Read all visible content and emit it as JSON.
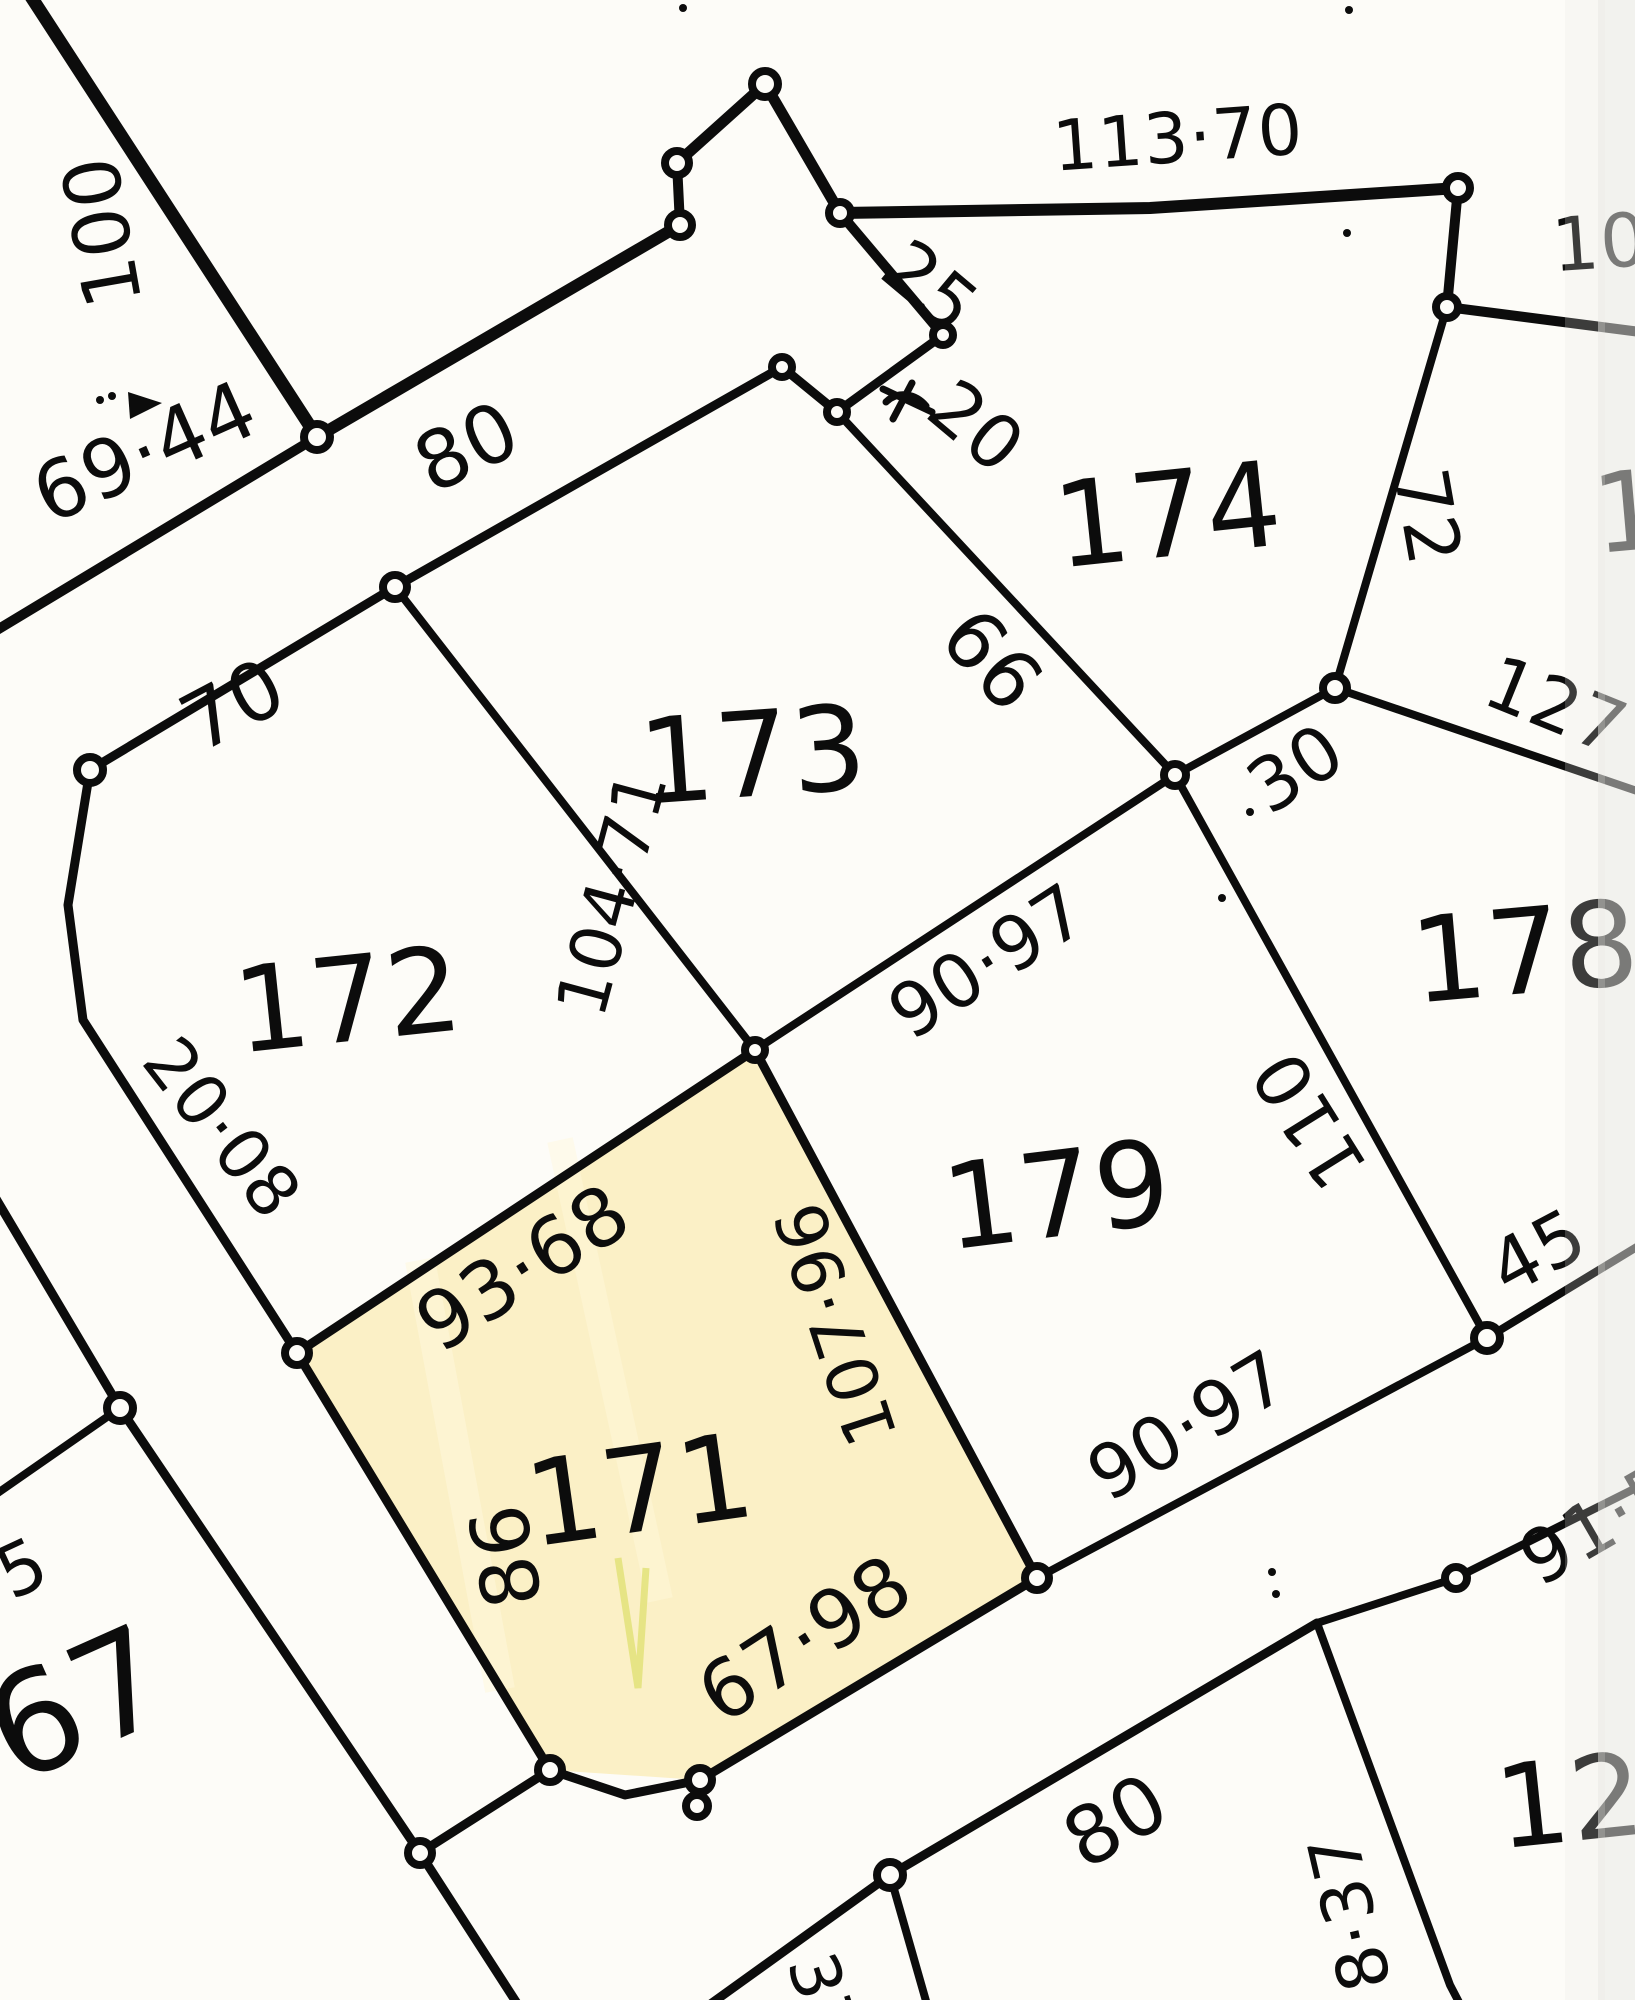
{
  "canvas": {
    "width": 1635,
    "height": 2000,
    "background": "#fdfcf8",
    "ink": "#0c0c0c",
    "edge_shade": "#e7e7e4"
  },
  "highlight": {
    "lot": "171",
    "fill": "#fbf0c6",
    "streak": "#fff8dc",
    "pen_mark": "#e2e279",
    "polygon": [
      [
        297,
        1353
      ],
      [
        755,
        1050
      ],
      [
        1037,
        1578
      ],
      [
        700,
        1780
      ],
      [
        550,
        1770
      ]
    ]
  },
  "labels": [
    {
      "name": "lot-number-171",
      "kind": "lot-number",
      "text": "171",
      "x": 640,
      "y": 1490,
      "rot": -8,
      "size": 118
    },
    {
      "name": "lot-number-172",
      "kind": "lot-number",
      "text": "172",
      "x": 348,
      "y": 1000,
      "rot": -6,
      "size": 118
    },
    {
      "name": "lot-number-173",
      "kind": "lot-number",
      "text": "173",
      "x": 753,
      "y": 755,
      "rot": -4,
      "size": 118
    },
    {
      "name": "lot-number-174",
      "kind": "lot-number",
      "text": "174",
      "x": 1168,
      "y": 515,
      "rot": -6,
      "size": 118
    },
    {
      "name": "lot-number-178",
      "kind": "lot-number",
      "text": "178",
      "x": 1525,
      "y": 952,
      "rot": -5,
      "size": 118
    },
    {
      "name": "lot-number-179",
      "kind": "lot-number",
      "text": "179",
      "x": 1057,
      "y": 1195,
      "rot": -7,
      "size": 118
    },
    {
      "name": "lot-number-67",
      "kind": "lot-number",
      "text": "67",
      "x": 78,
      "y": 1705,
      "rot": -24,
      "size": 140
    },
    {
      "name": "lot-number-12",
      "kind": "lot-number",
      "text": "12",
      "x": 1570,
      "y": 1802,
      "rot": -6,
      "size": 115
    },
    {
      "name": "lot-number-partial-right",
      "kind": "lot-number",
      "text": "1",
      "x": 1628,
      "y": 512,
      "rot": -5,
      "size": 110
    },
    {
      "name": "dimension-100",
      "kind": "dimension",
      "text": "100",
      "x": 103,
      "y": 232,
      "rot": -100,
      "size": 78
    },
    {
      "name": "dimension-69-44",
      "kind": "dimension",
      "text": "69·44",
      "x": 145,
      "y": 452,
      "rot": -24,
      "size": 80
    },
    {
      "name": "dimension-80-top",
      "kind": "dimension",
      "text": "80",
      "x": 467,
      "y": 447,
      "rot": -26,
      "size": 80
    },
    {
      "name": "dimension-70",
      "kind": "dimension",
      "text": "70",
      "x": 233,
      "y": 705,
      "rot": -28,
      "size": 80
    },
    {
      "name": "dimension-113-70",
      "kind": "dimension",
      "text": "113·70",
      "x": 1178,
      "y": 138,
      "rot": -4,
      "size": 70
    },
    {
      "name": "dimension-25",
      "kind": "dimension",
      "text": "25",
      "x": 930,
      "y": 287,
      "rot": 40,
      "size": 74
    },
    {
      "name": "dimension-20",
      "kind": "dimension",
      "text": "20",
      "x": 976,
      "y": 427,
      "rot": 40,
      "size": 74
    },
    {
      "name": "dimension-10-partial",
      "kind": "dimension",
      "text": "10",
      "x": 1600,
      "y": 243,
      "rot": -4,
      "size": 74
    },
    {
      "name": "dimension-72",
      "kind": "dimension",
      "text": "72",
      "x": 1427,
      "y": 517,
      "rot": 80,
      "size": 74
    },
    {
      "name": "dimension-127-partial",
      "kind": "dimension",
      "text": "127",
      "x": 1556,
      "y": 706,
      "rot": 22,
      "size": 74
    },
    {
      "name": "dimension-66",
      "kind": "dimension",
      "text": "66",
      "x": 992,
      "y": 660,
      "rot": 48,
      "size": 80
    },
    {
      "name": "dimension-104-71",
      "kind": "dimension",
      "text": "104·71",
      "x": 612,
      "y": 893,
      "rot": -75,
      "size": 70
    },
    {
      "name": "dimension-30",
      "kind": "dimension",
      "text": "30",
      "x": 1296,
      "y": 769,
      "rot": -33,
      "size": 74
    },
    {
      "name": "dimension-90-97-upper",
      "kind": "dimension",
      "text": "90·97",
      "x": 988,
      "y": 962,
      "rot": -33,
      "size": 74
    },
    {
      "name": "dimension-20-08",
      "kind": "dimension",
      "text": "20·08",
      "x": 222,
      "y": 1128,
      "rot": 52,
      "size": 70
    },
    {
      "name": "dimension-110",
      "kind": "dimension",
      "text": "110",
      "x": 1310,
      "y": 1120,
      "rot": -122,
      "size": 74
    },
    {
      "name": "dimension-93-68",
      "kind": "dimension",
      "text": "93·68",
      "x": 523,
      "y": 1268,
      "rot": -33,
      "size": 80
    },
    {
      "name": "dimension-107-96",
      "kind": "dimension",
      "text": "107·96",
      "x": 836,
      "y": 1324,
      "rot": -108,
      "size": 70
    },
    {
      "name": "dimension-45",
      "kind": "dimension",
      "text": "45",
      "x": 1538,
      "y": 1252,
      "rot": -28,
      "size": 74
    },
    {
      "name": "dimension-86",
      "kind": "dimension",
      "text": "86",
      "x": 506,
      "y": 1556,
      "rot": -100,
      "size": 80
    },
    {
      "name": "dimension-90-97-lower",
      "kind": "dimension",
      "text": "90·97",
      "x": 1188,
      "y": 1426,
      "rot": -31,
      "size": 74
    },
    {
      "name": "dimension-67-98",
      "kind": "dimension",
      "text": "67·98",
      "x": 805,
      "y": 1639,
      "rot": -33,
      "size": 80
    },
    {
      "name": "dimension-91-5-partial",
      "kind": "dimension",
      "text": "91·5",
      "x": 1600,
      "y": 1524,
      "rot": -30,
      "size": 74
    },
    {
      "name": "dimension-80-bottom",
      "kind": "dimension",
      "text": "80",
      "x": 1116,
      "y": 1821,
      "rot": -30,
      "size": 80
    },
    {
      "name": "dimension-8-37",
      "kind": "dimension",
      "text": "8·37",
      "x": 1350,
      "y": 1912,
      "rot": -103,
      "size": 70
    },
    {
      "name": "dimension-5-partial",
      "kind": "dimension",
      "text": "5",
      "x": 22,
      "y": 1568,
      "rot": -25,
      "size": 72
    },
    {
      "name": "dimension-37-partial",
      "kind": "dimension",
      "text": "37",
      "x": 822,
      "y": 1998,
      "rot": 72,
      "size": 68
    }
  ],
  "geometry": {
    "segments": [
      {
        "w": 13,
        "pts": [
          [
            28,
            -8
          ],
          [
            317,
            437
          ]
        ]
      },
      {
        "w": 12,
        "pts": [
          [
            317,
            437
          ],
          [
            680,
            225
          ]
        ]
      },
      {
        "w": 10,
        "pts": [
          [
            680,
            225
          ],
          [
            677,
            163
          ]
        ]
      },
      {
        "w": 11,
        "pts": [
          [
            677,
            163
          ],
          [
            765,
            84
          ]
        ]
      },
      {
        "w": 11,
        "pts": [
          [
            765,
            84
          ],
          [
            840,
            213
          ]
        ]
      },
      {
        "w": 12,
        "pts": [
          [
            840,
            213
          ],
          [
            1150,
            208
          ],
          [
            1458,
            188
          ]
        ]
      },
      {
        "w": 10,
        "pts": [
          [
            1458,
            188
          ],
          [
            1447,
            307
          ]
        ]
      },
      {
        "w": 10,
        "pts": [
          [
            1447,
            307
          ],
          [
            1640,
            332
          ]
        ]
      },
      {
        "w": 8,
        "pts": [
          [
            1447,
            307
          ],
          [
            1335,
            688
          ]
        ]
      },
      {
        "w": 10,
        "pts": [
          [
            840,
            213
          ],
          [
            943,
            335
          ]
        ]
      },
      {
        "w": 9,
        "pts": [
          [
            943,
            335
          ],
          [
            837,
            412
          ]
        ]
      },
      {
        "w": 9,
        "pts": [
          [
            837,
            412
          ],
          [
            782,
            367
          ]
        ]
      },
      {
        "w": 9,
        "pts": [
          [
            782,
            367
          ],
          [
            395,
            587
          ]
        ]
      },
      {
        "w": 9,
        "pts": [
          [
            395,
            587
          ],
          [
            90,
            770
          ]
        ]
      },
      {
        "w": 10,
        "pts": [
          [
            317,
            437
          ],
          [
            -8,
            633
          ]
        ]
      },
      {
        "w": 9,
        "pts": [
          [
            90,
            770
          ],
          [
            68,
            905
          ],
          [
            83,
            1020
          ],
          [
            297,
            1353
          ]
        ]
      },
      {
        "w": 8,
        "pts": [
          [
            395,
            587
          ],
          [
            755,
            1050
          ]
        ]
      },
      {
        "w": 8,
        "pts": [
          [
            837,
            412
          ],
          [
            1175,
            775
          ]
        ]
      },
      {
        "w": 8,
        "pts": [
          [
            1175,
            775
          ],
          [
            1335,
            688
          ]
        ]
      },
      {
        "w": 8,
        "pts": [
          [
            1335,
            688
          ],
          [
            1640,
            792
          ]
        ]
      },
      {
        "w": 8,
        "pts": [
          [
            755,
            1050
          ],
          [
            1175,
            775
          ]
        ]
      },
      {
        "w": 8,
        "pts": [
          [
            1175,
            775
          ],
          [
            1487,
            1338
          ]
        ]
      },
      {
        "w": 9,
        "pts": [
          [
            755,
            1050
          ],
          [
            1037,
            1578
          ]
        ]
      },
      {
        "w": 9,
        "pts": [
          [
            297,
            1353
          ],
          [
            755,
            1050
          ]
        ]
      },
      {
        "w": 9,
        "pts": [
          [
            297,
            1353
          ],
          [
            550,
            1770
          ]
        ]
      },
      {
        "w": 9,
        "pts": [
          [
            550,
            1770
          ],
          [
            625,
            1795
          ],
          [
            700,
            1780
          ]
        ]
      },
      {
        "w": 9,
        "pts": [
          [
            700,
            1780
          ],
          [
            1037,
            1578
          ]
        ]
      },
      {
        "w": 8,
        "pts": [
          [
            1037,
            1578
          ],
          [
            1487,
            1338
          ]
        ]
      },
      {
        "w": 8,
        "pts": [
          [
            1487,
            1338
          ],
          [
            1640,
            1245
          ]
        ]
      },
      {
        "w": 9,
        "pts": [
          [
            -8,
            1192
          ],
          [
            120,
            1408
          ]
        ]
      },
      {
        "w": 9,
        "pts": [
          [
            120,
            1408
          ],
          [
            420,
            1853
          ]
        ]
      },
      {
        "w": 8,
        "pts": [
          [
            120,
            1408
          ],
          [
            -8,
            1497
          ]
        ]
      },
      {
        "w": 9,
        "pts": [
          [
            420,
            1853
          ],
          [
            550,
            1770
          ]
        ]
      },
      {
        "w": 9,
        "pts": [
          [
            420,
            1853
          ],
          [
            520,
            2008
          ]
        ]
      },
      {
        "w": 9,
        "pts": [
          [
            1317,
            1623
          ],
          [
            890,
            1875
          ]
        ]
      },
      {
        "w": 9,
        "pts": [
          [
            890,
            1875
          ],
          [
            705,
            2008
          ]
        ]
      },
      {
        "w": 8,
        "pts": [
          [
            890,
            1875
          ],
          [
            928,
            2008
          ]
        ]
      },
      {
        "w": 8,
        "pts": [
          [
            1317,
            1623
          ],
          [
            1456,
            1578
          ],
          [
            1640,
            1486
          ]
        ]
      },
      {
        "w": 8,
        "pts": [
          [
            1317,
            1623
          ],
          [
            1450,
            1985
          ],
          [
            1462,
            2008
          ]
        ]
      }
    ],
    "points": [
      {
        "x": 317,
        "y": 437,
        "r": 13
      },
      {
        "x": 680,
        "y": 225,
        "r": 12
      },
      {
        "x": 677,
        "y": 163,
        "r": 12
      },
      {
        "x": 765,
        "y": 84,
        "r": 13
      },
      {
        "x": 840,
        "y": 213,
        "r": 11
      },
      {
        "x": 943,
        "y": 335,
        "r": 10
      },
      {
        "x": 837,
        "y": 412,
        "r": 10
      },
      {
        "x": 782,
        "y": 367,
        "r": 10
      },
      {
        "x": 395,
        "y": 587,
        "r": 12
      },
      {
        "x": 90,
        "y": 770,
        "r": 13
      },
      {
        "x": 1458,
        "y": 188,
        "r": 12
      },
      {
        "x": 1447,
        "y": 307,
        "r": 11
      },
      {
        "x": 1335,
        "y": 688,
        "r": 12
      },
      {
        "x": 1175,
        "y": 775,
        "r": 11
      },
      {
        "x": 1487,
        "y": 1338,
        "r": 13
      },
      {
        "x": 120,
        "y": 1408,
        "r": 13
      },
      {
        "x": 297,
        "y": 1353,
        "r": 12
      },
      {
        "x": 755,
        "y": 1050,
        "r": 10
      },
      {
        "x": 1037,
        "y": 1578,
        "r": 12
      },
      {
        "x": 550,
        "y": 1770,
        "r": 12
      },
      {
        "x": 700,
        "y": 1780,
        "r": 12
      },
      {
        "x": 697,
        "y": 1806,
        "r": 11
      },
      {
        "x": 420,
        "y": 1853,
        "r": 12
      },
      {
        "x": 890,
        "y": 1875,
        "r": 13
      },
      {
        "x": 1456,
        "y": 1578,
        "r": 11
      }
    ],
    "dots": [
      [
        683,
        8
      ],
      [
        1349,
        10
      ],
      [
        1347,
        233
      ],
      [
        1250,
        812
      ],
      [
        1222,
        898
      ],
      [
        1272,
        1572
      ],
      [
        1276,
        1594
      ],
      [
        100,
        400
      ],
      [
        112,
        396
      ]
    ],
    "marks": {
      "triangle": "M128,392 L162,403 L130,419 Z",
      "scribble": [
        "M883,389 L932,412",
        "M912,383 L893,419",
        "M886,402 C898,390 916,394 926,406"
      ]
    }
  }
}
